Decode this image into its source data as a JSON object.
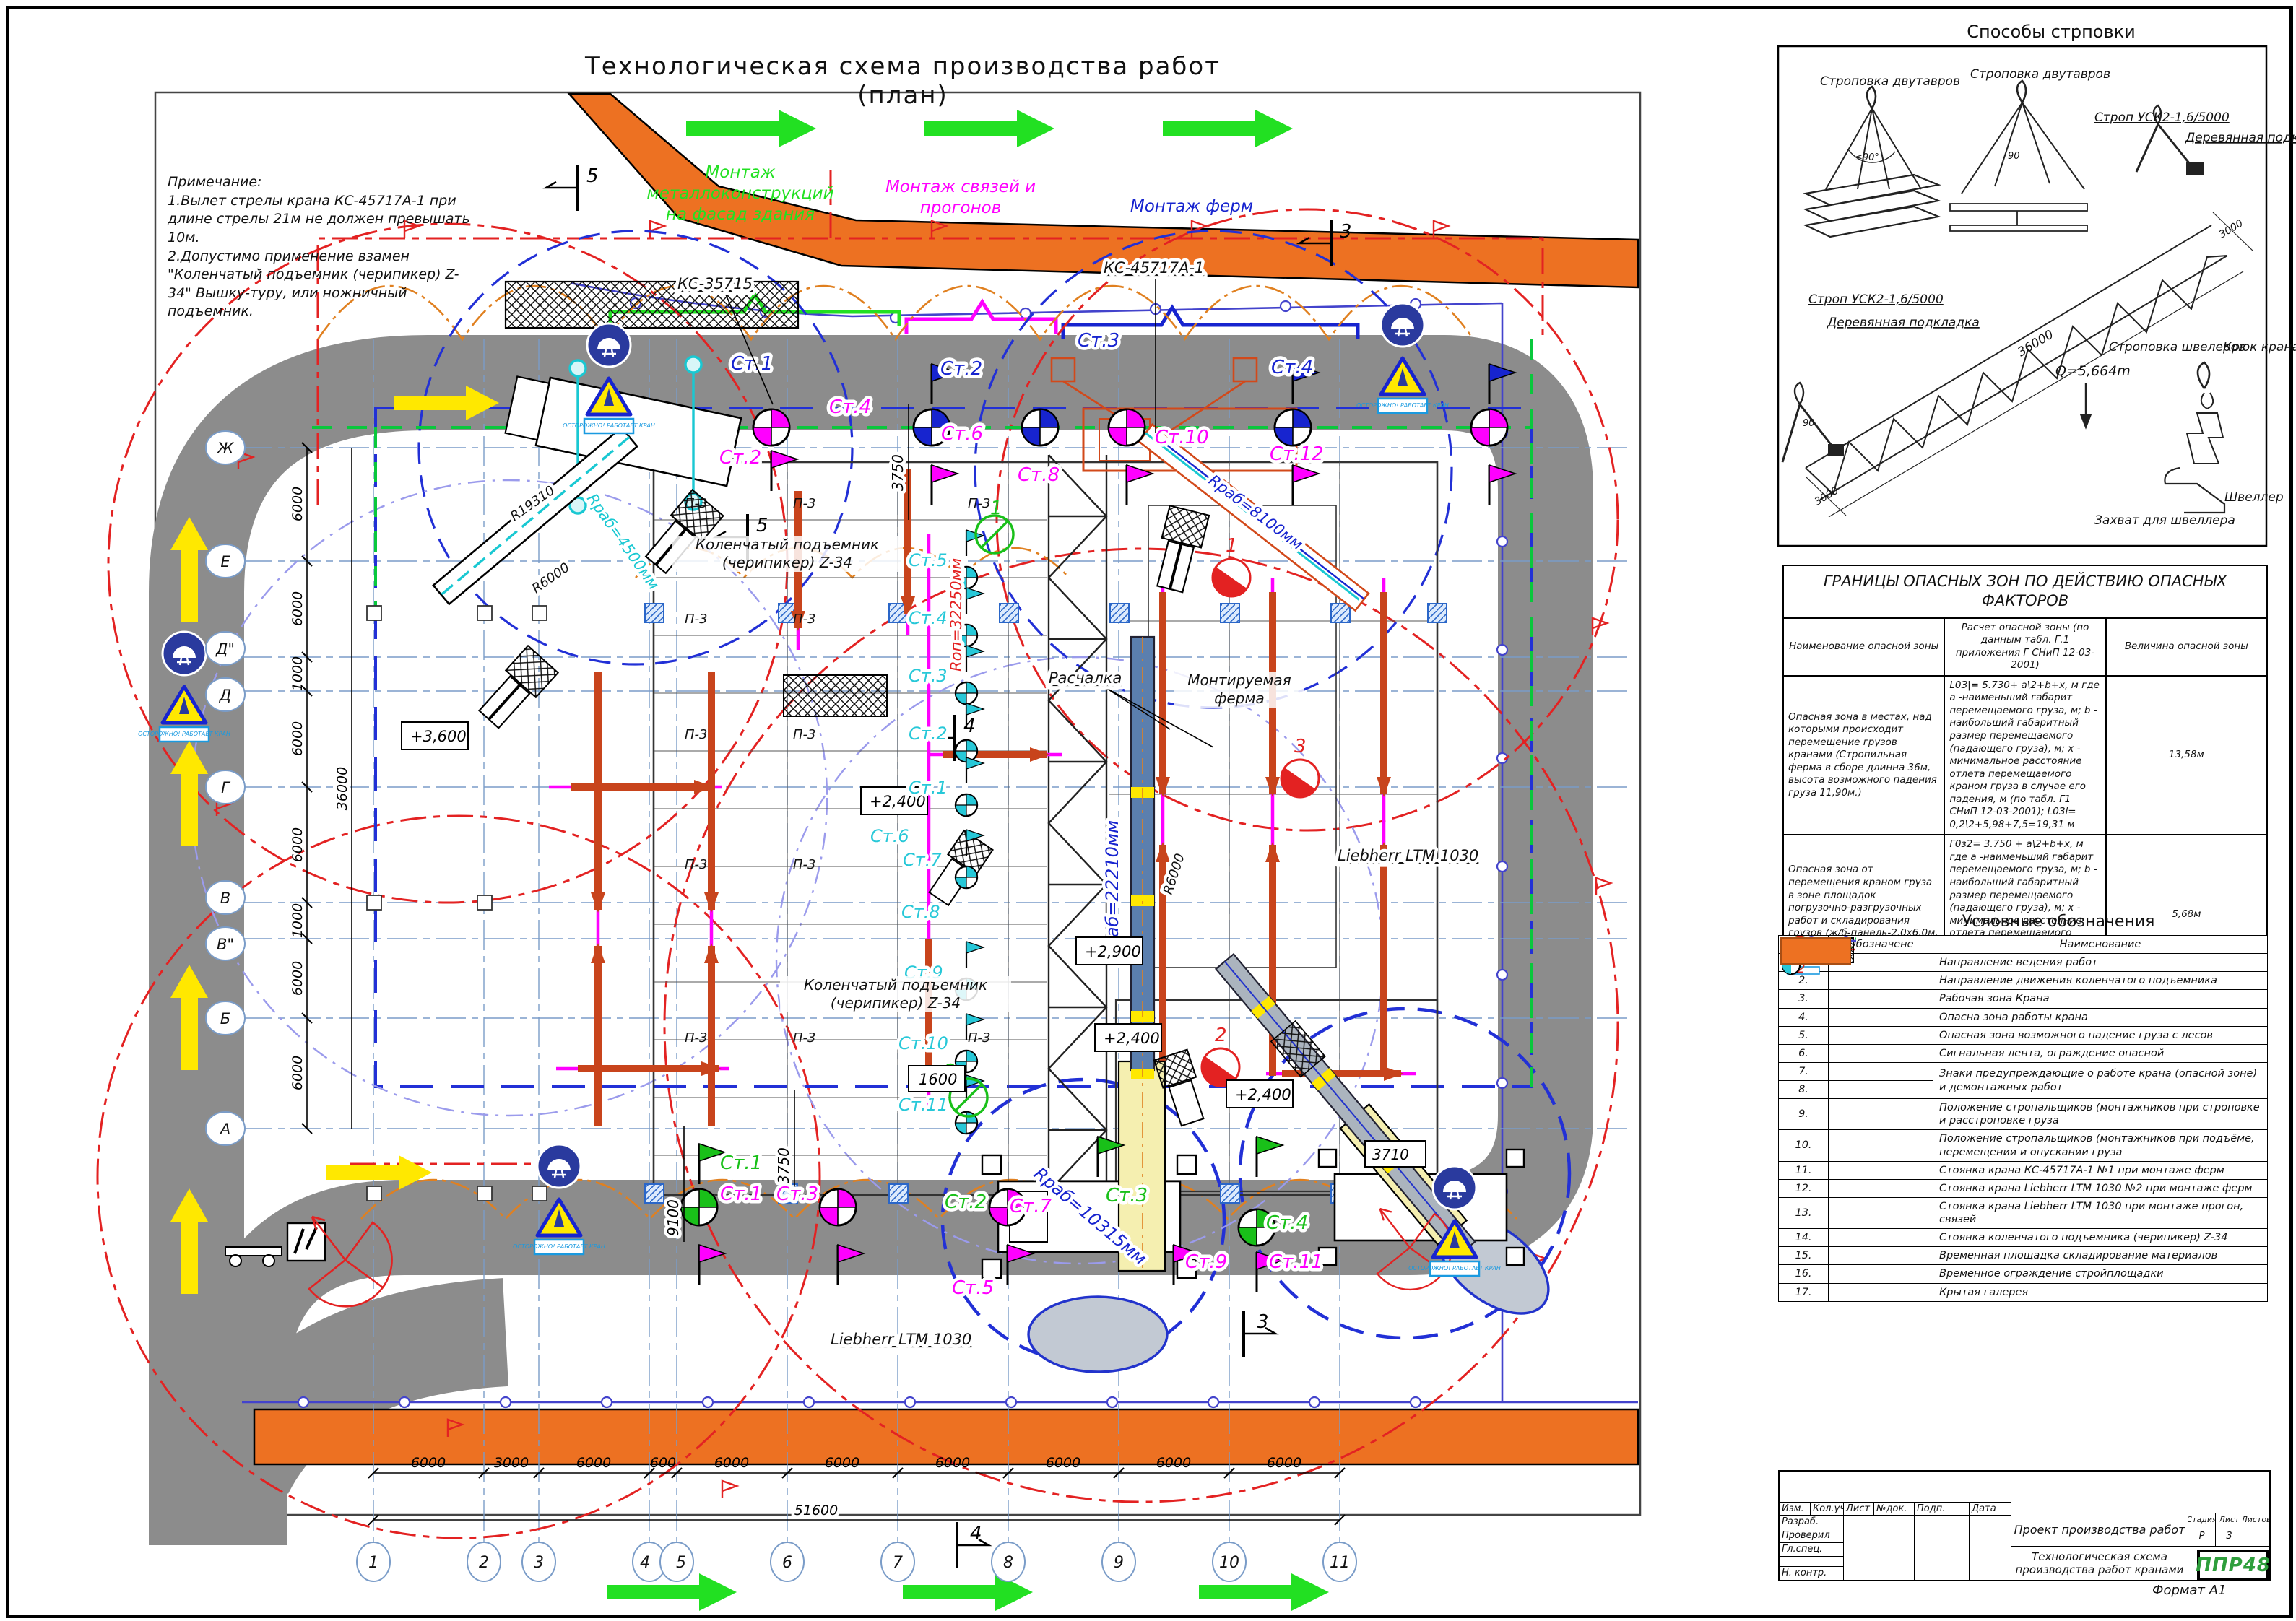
{
  "sheet": {
    "title": "Технологическая схема производства работ (план)",
    "format": "Формат А1"
  },
  "notes": {
    "head": "Примечание:",
    "l1": "1.Вылет стрелы крана КС-45717А-1 при длине стрелы 21м не должен превышать 10м.",
    "l2": "2.Допустимо применение взамен \"Коленчатый подъемник (черипикер) Z-34\" Вышку-туру, или ножничный подъемник."
  },
  "plan": {
    "montage_green": "Монтаж металлоконструкций на фасад здания",
    "montage_magenta": "Монтаж связей и прогонов",
    "montage_blue": "Монтаж ферм",
    "ks35715": "КС-35715",
    "ks45717": "КС-45717А-1",
    "cherry1": "Коленчатый подъемник (черипикер) Z-34",
    "cherry2": "Коленчатый подъемник (черипикер) Z-34",
    "liebherr1": "Liebherr LTM 1030",
    "liebherr2": "Liebherr LTM 1030",
    "truss_label": "Монтируемая ферма",
    "guy": "Расчалка",
    "panel": "П-3",
    "sign_caption": "ОСТОРОЖНО! РАБОТАЕТ КРАН",
    "r_rab4500": "Rраб=4500мм",
    "r_rab8100": "Rраб=8100мм",
    "r_rab22210": "Rраб=22210мм",
    "r_rab10315": "Rраб=10315мм",
    "r_op32250": "Rоп=32250мм",
    "r6000a": "R6000",
    "r6000b": "R6000",
    "r19310": "R19310",
    "e3600": "+3,600",
    "e2400a": "+2,400",
    "e2900": "+2,900",
    "e2400b": "+2,400",
    "e1600": "1600",
    "e2400c": "+2,400",
    "d51600": "51600",
    "d36000": "36000",
    "d9100": "9100",
    "d3750a": "3750",
    "d3750b": "3750",
    "d3710": "3710",
    "spans_bottom": [
      "6000",
      "3000",
      "6000",
      "600",
      "6000",
      "6000",
      "6000",
      "6000",
      "6000",
      "6000"
    ],
    "spans_left": [
      "6000",
      "6000",
      "1000",
      "6000",
      "6000",
      "1000",
      "6000",
      "6000"
    ],
    "cols": [
      "1",
      "2",
      "3",
      "4",
      "5",
      "6",
      "7",
      "8",
      "9",
      "10",
      "11"
    ],
    "rows": [
      "Ж",
      "Е",
      "Д\"",
      "Д",
      "Г",
      "В",
      "В\"",
      "Б",
      "А"
    ],
    "sec3": "3",
    "sec4": "4",
    "sec5": "5",
    "red1": "1",
    "red2": "2",
    "red3": "3",
    "grn1": "1",
    "grn2": "2",
    "stb": [
      "Ст.1",
      "Ст.2",
      "Ст.3",
      "Ст.4"
    ],
    "stm": [
      "Ст.2",
      "Ст.4",
      "Ст.6",
      "Ст.8",
      "Ст.10",
      "Ст.12"
    ],
    "stg": [
      "Ст.1",
      "Ст.2",
      "Ст.3",
      "Ст.4"
    ],
    "stmb": [
      "Ст.1",
      "Ст.3",
      "Ст.5",
      "Ст.7",
      "Ст.9",
      "Ст.11"
    ],
    "stc": [
      "Ст.5",
      "Ст.4",
      "Ст.3",
      "Ст.2",
      "Ст.1",
      "Ст.6",
      "Ст.7",
      "Ст.8",
      "Ст.9",
      "Ст.10",
      "Ст.11"
    ]
  },
  "strapping": {
    "title": "Способы стрповки",
    "dv1": "Строповка двутавров",
    "dv2": "Строповка двутавров",
    "strop1": "Строп УСК2-1,6/5000",
    "strop2": "Строп УСК2-1,6/5000",
    "pad1": "Деревянная подкладка",
    "pad2": "Деревянная подкладка",
    "dim36000": "36000",
    "dim3000a": "3000",
    "dim3000b": "3000",
    "q": "Q=5,664m",
    "shv": "Строповка швелеров",
    "hook": "Крюк крана",
    "grab": "Захват для швеллера",
    "channel": "Швеллер",
    "a90a": "≤90°",
    "a90b": "90",
    "a90c": "90"
  },
  "hazard": {
    "title": "ГРАНИЦЫ ОПАСНЫХ ЗОН ПО ДЕЙСТВИЮ ОПАСНЫХ ФАКТОРОВ",
    "h1": "Наименование опасной зоны",
    "h2": "Расчет опасной зоны (по данным табл. Г.1 приложения Г СНиП 12-03-2001)",
    "h3": "Величина опасной зоны",
    "rows": [
      {
        "name": "Опасная зона в местах, над которыми происходит перемещение грузов кранами (Стропильная ферма в сборе длинна 36м, высота возможного падения груза 11,90м.)",
        "calc": "L0З|= 5.730+ а\\2+b+х, м где а -наименьший габарит перемещаемого груза, м; b - наибольший габаритный размер перемещаемого (падающего груза), м; х - минимальное расстояние отлета перемещаемого краном груза в случае его падения, м (по табл. Г1 СНиП 12-03-2001); L0Зl= 0,2\\2+5,98+7,5=19,31 м",
        "val": "13,58м"
      },
      {
        "name": "Опасная зона от перемещения краном груза в зоне площадок погрузочно-разгрузочных работ и складирования грузов (ж/б-панель-2.0х6.0м, высота возможного падения груза 0,5 м)",
        "calc": "Г0з2= 3.750 + а\\2+b+х, м где а -наименьший габарит перемещаемого груза, м; b - наибольший габаритный размер перемещаемого (падающего груза), м; х - минимальное расстояние отлета перемещаемого краном груза в случае его падения, м(по табл. Г1 СНиП 12-03-2001); L0З2= 0,2\\2+5,58=9,43 м",
        "val": "5,68м"
      },
      {
        "name": "Опасная зона от случайного падения груза со здания и с вышки АПГ-40 (максимальный габарит груза 0,5 молоток м, высота возможного падения груза 24,90м.)",
        "calc": "Е0Зз= b+х, м где b - наибольший габаритный размер падающего груза, м; х - минимальное расстояние падения груза со здания, м (по табл. Г1 СНиП 12-03-2001); bоз2= 0,5+5,0м.=5,5",
        "val": "5,5м"
      }
    ]
  },
  "legend": {
    "title": "Условные обозначения",
    "hn": "№",
    "ho": "Обозначене",
    "hname": "Наименование",
    "icon2": "2",
    "icon2b": "2",
    "rows": [
      {
        "num": "1.",
        "name": "Направление ведения работ"
      },
      {
        "num": "2.",
        "name": "Направление движения коленчатого подъемника"
      },
      {
        "num": "3.",
        "name": "Рабочая зона Крана"
      },
      {
        "num": "4.",
        "name": "Опасна зона работы крана"
      },
      {
        "num": "5.",
        "name": "Опасная зона возможного падение груза с лесов"
      },
      {
        "num": "6.",
        "name": "Сигнальная лента, ограждение опасной"
      },
      {
        "num": "7.",
        "name": "Знаки предупреждающие о работе крана (опасной зоне) и демонтажных работ"
      },
      {
        "num": "8.",
        "name": ""
      },
      {
        "num": "9.",
        "name": "Положение стропальщиков (монтажников при строповке и расстроповке груза"
      },
      {
        "num": "10.",
        "name": "Положение стропальщиков (монтажников при подъёме, перемещении и опускании груза"
      },
      {
        "num": "11.",
        "name": "Стоянка крана КС-45717А-1 №1 при монтаже ферм"
      },
      {
        "num": "12.",
        "name": "Стоянка крана Liebherr LTM 1030 №2 при монтаже ферм"
      },
      {
        "num": "13.",
        "name": "Стоянка крана Liebherr LTM 1030 при монтаже прогон, связей"
      },
      {
        "num": "14.",
        "name": "Стоянка коленчатого подъемника (черипикер) Z-34"
      },
      {
        "num": "15.",
        "name": "Временная площадка складирование материалов"
      },
      {
        "num": "16.",
        "name": "Временное ограждение стройплощадки"
      },
      {
        "num": "17.",
        "name": "Крытая галерея"
      }
    ]
  },
  "tb": {
    "izm": "Изм.",
    "kol": "Кол.уч",
    "list": "Лист",
    "ndoc": "№док.",
    "podp": "Подп.",
    "data": "Дата",
    "razrab": "Разраб.",
    "prov": "Проверил",
    "gl": "Гл.спец.",
    "nk": "Н. контр.",
    "proj": "Проект производства работ",
    "doc": "Технологическая схема производства работ кранами",
    "stad": "Стадия",
    "l": "Лист",
    "lv": "Листов",
    "stv": "Р",
    "lval": "3",
    "logo": "ППР48"
  }
}
